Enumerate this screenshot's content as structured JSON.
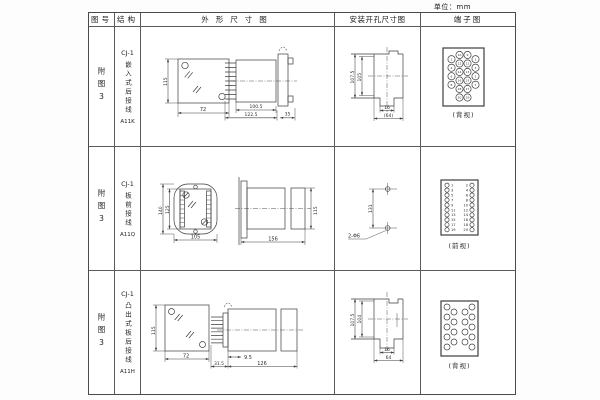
{
  "unit_label": "单位：mm",
  "headers": {
    "fig_no": "图号",
    "structure": "结构",
    "outline": "外形尺寸图",
    "install": "安装开孔尺寸图",
    "terminal": "端子图"
  },
  "rows": [
    {
      "fig_no": "附图3",
      "model": "CJ-1",
      "structure": "嵌入式后接线",
      "code": "A11K",
      "outline": {
        "height": "115",
        "width": "72",
        "body_len": "100.5",
        "total_len": "122.5",
        "flange": "35"
      },
      "install": {
        "outer": "107.5",
        "inner": "105",
        "notch": "16",
        "span": "(64)"
      },
      "terminal": {
        "label": "(背视)",
        "outer_left": [
          2,
          4,
          6,
          8
        ],
        "mid_left": [
          10,
          12,
          14,
          16,
          18,
          20
        ],
        "mid_right": [
          9,
          11,
          13,
          15,
          17,
          19
        ],
        "outer_right": [
          1,
          3,
          5,
          7
        ]
      }
    },
    {
      "fig_no": "附图3",
      "model": "CJ-1",
      "structure": "板前接线",
      "code": "A11Q",
      "outline": {
        "outer_height": "140",
        "inner_height": "125",
        "width": "105",
        "length": "156",
        "side_height": "115"
      },
      "install": {
        "span": "131",
        "holes": "2-Φ6"
      },
      "terminal": {
        "label": "(前视)",
        "left": [
          1,
          3,
          5,
          7,
          9,
          11,
          13,
          15,
          17,
          19
        ],
        "right": [
          2,
          4,
          6,
          8,
          10,
          12,
          14,
          16,
          18,
          20
        ]
      }
    },
    {
      "fig_no": "附图3",
      "model": "CJ-1",
      "structure": "凸出式板后接线",
      "code": "A11H",
      "outline": {
        "height": "115",
        "width": "72",
        "pins": "31.5",
        "offset": "9.5",
        "length": "126"
      },
      "install": {
        "outer": "107.5",
        "inner": "104",
        "notch": "16",
        "span": "64"
      },
      "terminal": {
        "label": "(背视)"
      }
    }
  ]
}
